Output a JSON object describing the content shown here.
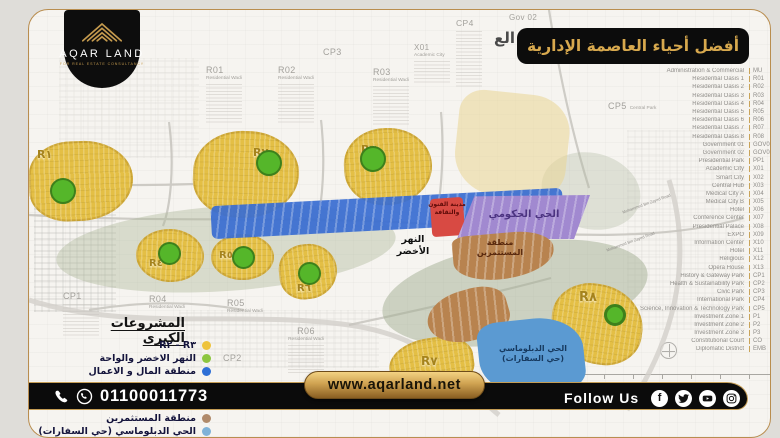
{
  "colors": {
    "gold": "#c49a4e",
    "black": "#0c0c0c",
    "card_border": "#b98d4f",
    "residential_yellow": "#e4bf45",
    "cbd_blue": "#3a6ed2",
    "arts_red": "#d84a43",
    "government_purple": "#a189d0",
    "investors_brown": "#b8834f",
    "diplomatic_blue": "#5b9ad2",
    "green_marker": "#55b62a"
  },
  "brand": {
    "name": "AQAR LAND",
    "tagline": "FOR REAL ESTATE CONSULTANCY"
  },
  "banner": {
    "title": "أفضل أحياء العاصمة الإدارية"
  },
  "map": {
    "title_fragment": "الع",
    "top_labels": [
      {
        "code": "R01",
        "sub": "Residential Wadi"
      },
      {
        "code": "R02",
        "sub": "Residential Wadi"
      },
      {
        "code": "R03",
        "sub": "Residential Wadi"
      },
      {
        "code": "CP3",
        "sub": ""
      },
      {
        "code": "X01",
        "sub": "Academic City"
      },
      {
        "code": "CP4",
        "sub": ""
      },
      {
        "code": "Gov 02",
        "sub": ""
      },
      {
        "code": "CP5",
        "sub": "Central Park"
      }
    ],
    "bottom_labels": [
      {
        "code": "CP1",
        "sub": ""
      },
      {
        "code": "R04",
        "sub": "Residential Wadi"
      },
      {
        "code": "R05",
        "sub": "Residential Wadi"
      },
      {
        "code": "R06",
        "sub": "Residential Wadi"
      },
      {
        "code": "CP2",
        "sub": ""
      }
    ],
    "districts": [
      {
        "label": "R١"
      },
      {
        "label": "R٢"
      },
      {
        "label": "R٣"
      },
      {
        "label": "R٤"
      },
      {
        "label": "R٥"
      },
      {
        "label": "R٦"
      },
      {
        "label": "R٧"
      },
      {
        "label": "R٨"
      }
    ],
    "zones": {
      "arts": "مدينة الفنون والثقافة",
      "government": "الحي الحكومي",
      "investors": "منطقة المستثمرين",
      "diplomatic_1": "الحي الدبلوماسي",
      "diplomatic_2": "(حي السفارات)",
      "river": "النهر الأخضر",
      "road": "Mohammed Bin Zayed Road"
    }
  },
  "legend_right": {
    "rows": [
      {
        "label": "Administration & Commercial",
        "code": "MU"
      },
      {
        "label": "Residential Oasis 1",
        "code": "R01"
      },
      {
        "label": "Residential Oasis 2",
        "code": "R02"
      },
      {
        "label": "Residential Oasis 3",
        "code": "R03"
      },
      {
        "label": "Residential Oasis 4",
        "code": "R04"
      },
      {
        "label": "Residential Oasis 5",
        "code": "R05"
      },
      {
        "label": "Residential Oasis 6",
        "code": "R06"
      },
      {
        "label": "Residential Oasis 7",
        "code": "R07"
      },
      {
        "label": "Residential Oasis 8",
        "code": "R08"
      },
      {
        "label": "Government 01",
        "code": "GOV01"
      },
      {
        "label": "Government 02",
        "code": "GOV02"
      },
      {
        "label": "Presidential Park",
        "code": "PP1"
      },
      {
        "label": "Academic City",
        "code": "X01"
      },
      {
        "label": "Smart City",
        "code": "X02"
      },
      {
        "label": "Central Hub",
        "code": "X03"
      },
      {
        "label": "Medical City A",
        "code": "X04"
      },
      {
        "label": "Medical City B",
        "code": "X05"
      },
      {
        "label": "Hotel",
        "code": "X06"
      },
      {
        "label": "Conference Center",
        "code": "X07"
      },
      {
        "label": "Presidential Palace",
        "code": "X08"
      },
      {
        "label": "EXPO",
        "code": "X09"
      },
      {
        "label": "Information Center",
        "code": "X10"
      },
      {
        "label": "Hotel",
        "code": "X11"
      },
      {
        "label": "Religious",
        "code": "X12"
      },
      {
        "label": "Opera House",
        "code": "X13"
      },
      {
        "label": "History & Gateway Park",
        "code": "CP1"
      },
      {
        "label": "Health & Sustainability Park",
        "code": "CP2"
      },
      {
        "label": "Civic Park",
        "code": "CP3"
      },
      {
        "label": "International Park",
        "code": "CP4"
      },
      {
        "label": "Science, Innovation & Technology Park",
        "code": "CP5"
      },
      {
        "label": "Investment Zone 1",
        "code": "P1"
      },
      {
        "label": "Investment Zone 2",
        "code": "P2"
      },
      {
        "label": "Investment Zone 3",
        "code": "P3"
      },
      {
        "label": "Constitutional Court",
        "code": "CO"
      },
      {
        "label": "Diplomatic District",
        "code": "EMB"
      }
    ]
  },
  "legend_left": {
    "title": "المشروعات الكبرى",
    "items_top": [
      {
        "label": "R٢ - R٣",
        "color": "#eec33c"
      },
      {
        "label": "النهر الاخضر والواحة",
        "color": "#8cc63f"
      },
      {
        "label": "منطقة المال و الاعمال",
        "color": "#2e6fd6"
      }
    ],
    "items_bottom": [
      {
        "label": "منطقة المستثمرين",
        "color": "#b08a6a"
      },
      {
        "label": "الحي الدبلوماسي (حي السفارات)",
        "color": "#7fb2d8"
      }
    ]
  },
  "footer": {
    "phone": "01100011773",
    "website": "www.aqarland.net",
    "follow_label": "Follow Us",
    "socials": [
      "facebook",
      "twitter",
      "youtube",
      "instagram"
    ]
  }
}
